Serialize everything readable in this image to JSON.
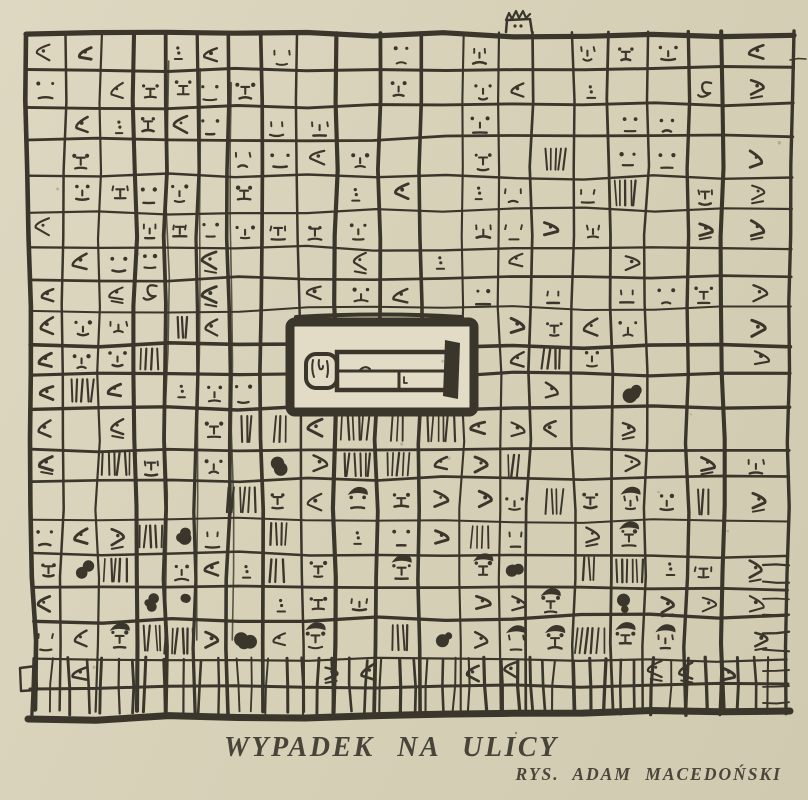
{
  "colors": {
    "paper": "#d7d1b8",
    "panel_fill": "#e2dcc6",
    "ink": "#3a362b",
    "caption_text": "#48443a"
  },
  "caption": {
    "title": "WYPADEK NA ULICY",
    "credit": "RYS. ADAM MACEDOŃSKI"
  },
  "illustration": {
    "alt": "Hand-drawn cartoon: a huge building facade made of a wobbly grid of windows crowded with staring faces; in the centre a heavy black-framed blank panel holds a schematic figure lying flat on the street; a lone figure peeks over the roofline; dense hatching, ink blobs and hair-capped heads fill the lower storeys above a fence-like base."
  }
}
